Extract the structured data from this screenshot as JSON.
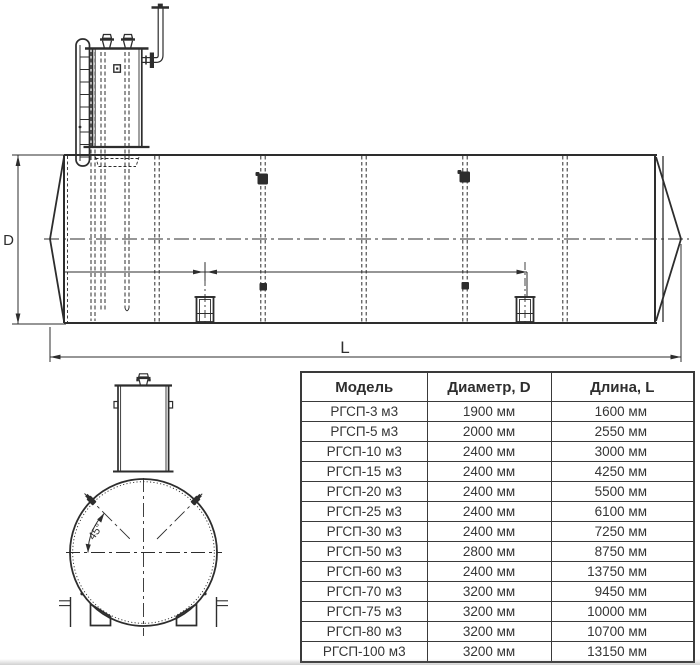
{
  "title": "Horizontal steel tank РГСП dimensional drawing with specification table",
  "colors": {
    "line": "#2d2d2d",
    "table_border": "#3a3a3a",
    "background": "#ffffff"
  },
  "side_view": {
    "labels": {
      "diameter": "D",
      "length": "L"
    }
  },
  "front_view": {
    "labels": {
      "angle": "45°"
    }
  },
  "table": {
    "headers": [
      "Модель",
      "Диаметр, D",
      "Длина, L"
    ],
    "rows": [
      {
        "model": "РГСП-3 м3",
        "diameter": "1900 мм",
        "length": "1600 мм"
      },
      {
        "model": "РГСП-5 м3",
        "diameter": "2000 мм",
        "length": "2550 мм"
      },
      {
        "model": "РГСП-10 м3",
        "diameter": "2400 мм",
        "length": "3000 мм"
      },
      {
        "model": "РГСП-15 м3",
        "diameter": "2400 мм",
        "length": "4250 мм"
      },
      {
        "model": "РГСП-20 м3",
        "diameter": "2400 мм",
        "length": "5500 мм"
      },
      {
        "model": "РГСП-25 м3",
        "diameter": "2400 мм",
        "length": "6100 мм"
      },
      {
        "model": "РГСП-30 м3",
        "diameter": "2400 мм",
        "length": "7250 мм"
      },
      {
        "model": "РГСП-50 м3",
        "diameter": "2800 мм",
        "length": "8750 мм"
      },
      {
        "model": "РГСП-60 м3",
        "diameter": "2400 мм",
        "length": "13750 мм"
      },
      {
        "model": "РГСП-70 м3",
        "diameter": "3200 мм",
        "length": "9450 мм"
      },
      {
        "model": "РГСП-75 м3",
        "diameter": "3200 мм",
        "length": "10000 мм"
      },
      {
        "model": "РГСП-80 м3",
        "diameter": "3200 мм",
        "length": "10700 мм"
      },
      {
        "model": "РГСП-100 м3",
        "diameter": "3200 мм",
        "length": "13150 мм"
      }
    ]
  }
}
